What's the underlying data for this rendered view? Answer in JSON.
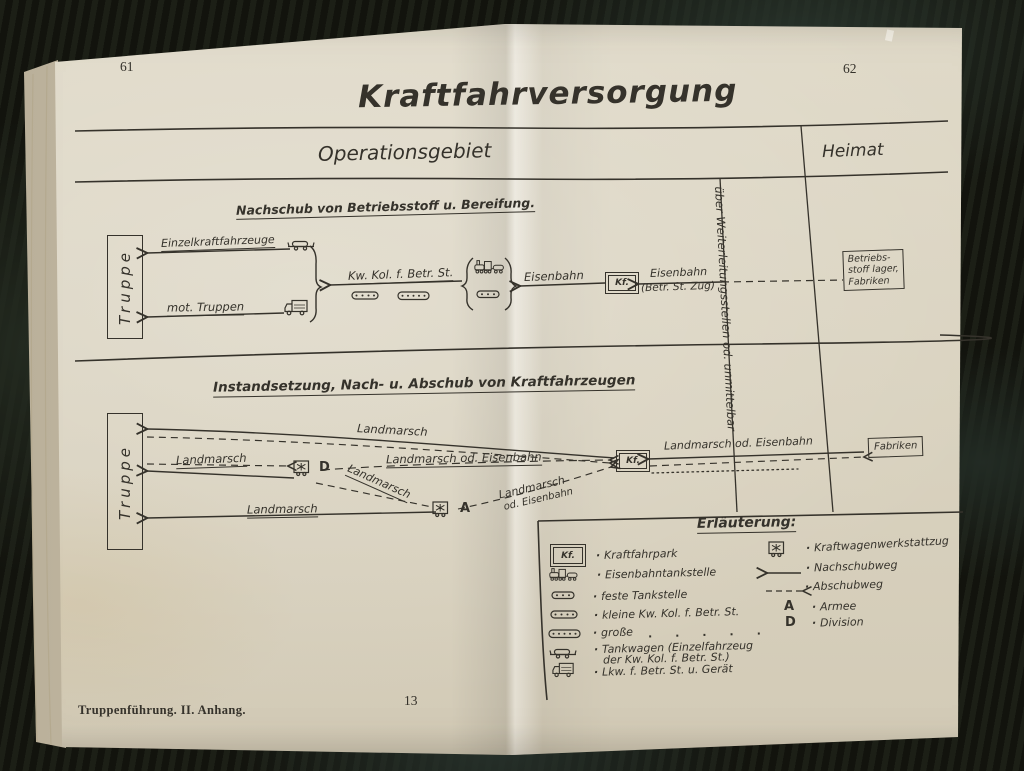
{
  "page": {
    "left_number": "61",
    "right_number": "62",
    "title": "Kraftfahrversorgung",
    "footer_left": "Truppenführung. II. Anhang.",
    "footer_page": "13"
  },
  "header": {
    "operationsgebiet": "Operationsgebiet",
    "heimat": "Heimat",
    "corridor": "über Weiterleitungsstellen od. unmittelbar"
  },
  "section1": {
    "heading": "Nachschub von Betriebsstoff u. Bereifung.",
    "truppe": "Truppe",
    "einzelkraftfahrzeuge": "Einzelkraftfahrzeuge",
    "mot_truppen": "mot. Truppen",
    "kw_kol": "Kw. Kol. f. Betr. St.",
    "eisenbahn": "Eisenbahn",
    "kf": "Kf.",
    "eisenbahn_zug": "Eisenbahn",
    "eisenbahn_zug_sub": "(Betr. St. Zug)",
    "source_box": [
      "Betriebs-",
      "stoff lager,",
      "Fabriken"
    ]
  },
  "section2": {
    "heading": "Instandsetzung, Nach- u. Abschub von Kraftfahrzeugen",
    "truppe": "Truppe",
    "landmarsch_top": "Landmarsch",
    "landmarsch_left": "Landmarsch",
    "landmarsch_od_eisenbahn": "Landmarsch od. Eisenbahn",
    "landmarsch_diag": "Landmarsch",
    "landmarsch_diag2a": "Landmarsch",
    "landmarsch_diag2b": "od. Eisenbahn",
    "landmarsch_bottom": "Landmarsch",
    "d": "D",
    "a": "A",
    "kf": "Kf.",
    "right_route": "Landmarsch  od.  Eisenbahn",
    "fabriken": "Fabriken"
  },
  "legend": {
    "heading": "Erläuterung:",
    "kf_icon_text": "Kf.",
    "left": [
      {
        "label": "Kraftfahrpark"
      },
      {
        "label": "Eisenbahntankstelle"
      },
      {
        "label": "feste Tankstelle"
      },
      {
        "label": "kleine Kw. Kol. f. Betr. St."
      },
      {
        "label": "große",
        "ditto": ".      .      .      .      ."
      },
      {
        "label": "Tankwagen (Einzelfahrzeug",
        "label2": "der Kw. Kol. f. Betr. St.)"
      },
      {
        "label": "Lkw. f. Betr. St. u. Gerät"
      }
    ],
    "right": [
      {
        "label": "Kraftwagenwerkstattzug"
      },
      {
        "label": "Nachschubweg"
      },
      {
        "label": "Abschubweg"
      },
      {
        "letter": "A",
        "label": "Armee"
      },
      {
        "letter": "D",
        "label": "Division"
      }
    ]
  },
  "colors": {
    "paper": "#d9d2bf",
    "ink": "#35322b",
    "background": "#15160f"
  }
}
